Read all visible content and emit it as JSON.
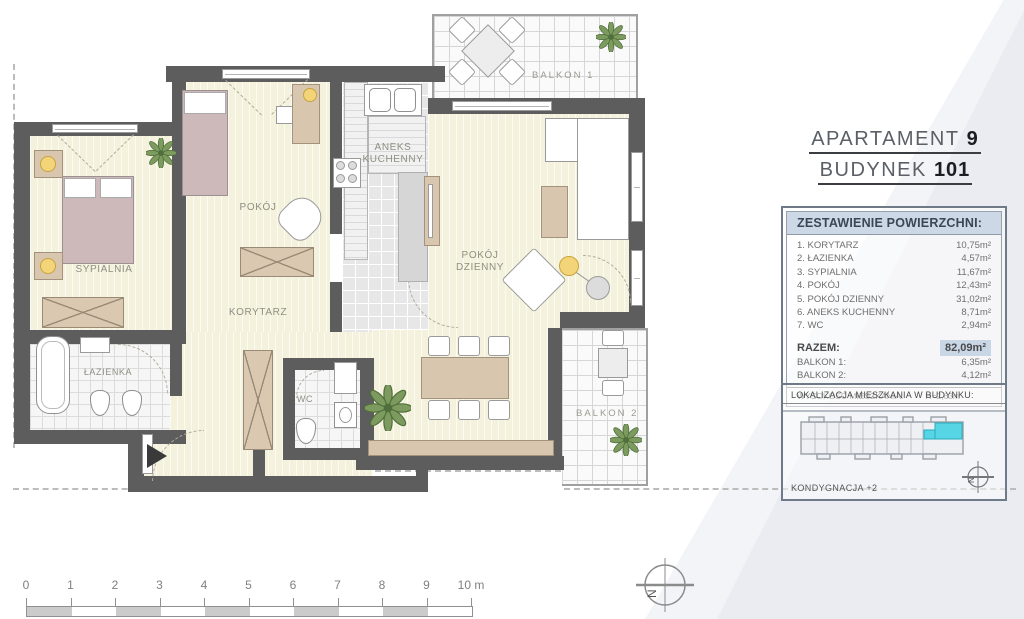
{
  "header": {
    "apartment_label": "APARTAMENT",
    "apartment_value": "9",
    "building_label": "BUDYNEK",
    "building_value": "101"
  },
  "area_table": {
    "title": "ZESTAWIENIE POWIERZCHNI:",
    "rows": [
      {
        "label": "1. KORYTARZ",
        "value": "10,75m²"
      },
      {
        "label": "2. ŁAZIENKA",
        "value": "4,57m²"
      },
      {
        "label": "3. SYPIALNIA",
        "value": "11,67m²"
      },
      {
        "label": "4. POKÓJ",
        "value": "12,43m²"
      },
      {
        "label": "5. POKÓJ DZIENNY",
        "value": "31,02m²"
      },
      {
        "label": "6. ANEKS KUCHENNY",
        "value": "8,71m²"
      },
      {
        "label": "7. WC",
        "value": "2,94m²"
      }
    ],
    "total": {
      "label": "RAZEM:",
      "value": "82,09m²"
    },
    "balconies": [
      {
        "label": "BALKON 1:",
        "value": "6,35m²"
      },
      {
        "label": "BALKON 2:",
        "value": "4,12m²"
      }
    ],
    "height_label": "WYSOKOŚĆ MIESZKANIA:",
    "height_value": "H=2,63m"
  },
  "location_panel": {
    "title": "LOKALIZACJA MIESZKANIA W BUDYNKU:",
    "floor_label": "KONDYGNACJA +2",
    "north_letter": "N",
    "highlight_color": "#57d5e5"
  },
  "plan": {
    "rooms": {
      "sypialnia": "SYPIALNIA",
      "pokoj": "POKÓJ",
      "korytarz": "KORYTARZ",
      "lazienka": "ŁAZIENKA",
      "wc": "WC",
      "aneks_kuchenny": "ANEKS KUCHENNY",
      "pokoj_dzienny": "POKÓJ DZIENNY",
      "balkon1": "BALKON 1",
      "balkon2": "BALKON 2"
    }
  },
  "scale_bar": {
    "ticks": [
      "0",
      "1",
      "2",
      "3",
      "4",
      "5",
      "6",
      "7",
      "8",
      "9",
      "10 m"
    ]
  },
  "compass": {
    "letter": "N"
  }
}
